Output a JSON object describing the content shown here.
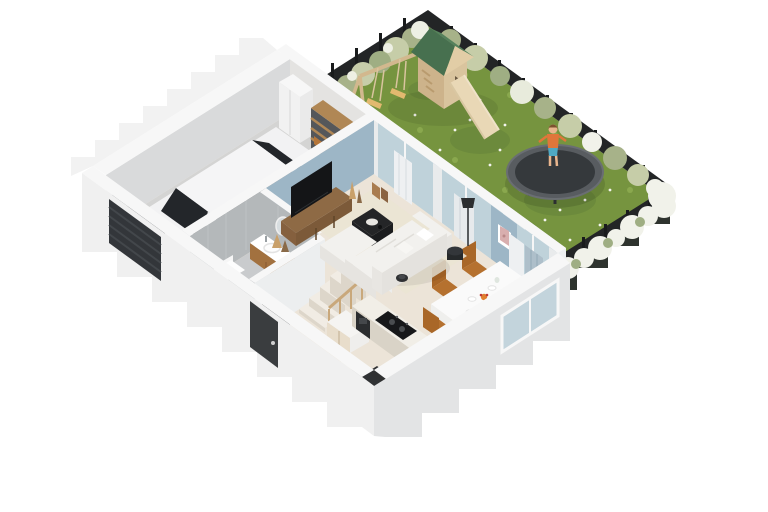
{
  "meta": {
    "description": "Isometric 3D cutaway rendering of a single-family house ground floor with attached garage and fenced garden",
    "view": "isometric-birdseye"
  },
  "colors": {
    "background": "#ffffff",
    "grass": "#76943f",
    "grassLight": "#8fae52",
    "grassDark": "#64823a",
    "fence": "#232526",
    "fencePost": "#191b1c",
    "fenceBelow": "#2e332e",
    "bushSage": "#a7b289",
    "bushLightGreen": "#c6cda8",
    "blossomWhite": "#f1f2ea",
    "playWood": "#d9c49e",
    "playWoodShade": "#cdb38b",
    "roofGreen": "#47704f",
    "roofGreenLight": "#55815c",
    "slideWood": "#e9d8b6",
    "swingSeat": "#e2b96f",
    "trampolineMat": "#35393c",
    "trampolineRim": "#585c60",
    "childShirt": "#e0763a",
    "childShorts": "#4fa8c2",
    "childSkin": "#e9b68e",
    "childHair": "#7d5230",
    "wallTop": "#f7f7f7",
    "wallInner": "#d9dadb",
    "wallOuterLight": "#f0f0f0",
    "wallOuterMid": "#e3e4e5",
    "wallFaceGarden": "#edf0f1",
    "accentBlue": "#9db6c6",
    "glass": "#bfd2da",
    "glassOuter": "#c3d4dc",
    "curtainWhite": "#eef0f2",
    "curtainGray": "#e7eaec",
    "curtainBlue": "#aebfca",
    "floorBeige": "#ece4d8",
    "garageFloor": "#d4d4d3",
    "bathFloor": "#c9cbcd",
    "bathWall": "#b4b8ba",
    "rug": "#ebe4d4",
    "doorDark": "#3a3d3f",
    "garageDoor": "#33363a",
    "mat": "#202224",
    "carBody": "#f2f2f3",
    "carGlass": "#23262a",
    "carWheel": "#232527",
    "sofa": "#f2f1ee",
    "sofaShade": "#e6e4e0",
    "tableBlack": "#242527",
    "woodFurniture": "#8e6a45",
    "tvBlack": "#141517",
    "counterFront": "#d9d3c7",
    "counterTop": "#f1eee7",
    "cooktop": "#17181a",
    "applianceDark": "#2b2d2f",
    "diningWhite": "#fafafa",
    "chairCaramel": "#b5712f",
    "chairShade": "#a96728",
    "vanityWood": "#a2713f",
    "ceramic": "#ffffff",
    "stairTread": "#f1ece4",
    "stairRail": "#c9a87b",
    "picnicWhite": "#f2f1ee"
  },
  "scene": {
    "house": {
      "rooms": [
        {
          "name": "garage",
          "objects": [
            "white-coupe-car",
            "sectional-garage-door",
            "tall-storage-cabinet",
            "wood-storage-shelf"
          ]
        },
        {
          "name": "living-room",
          "objects": [
            "corner-sofa",
            "coffee-table",
            "tv-sideboard",
            "flat-tv",
            "area-rug",
            "curtains",
            "framed-art",
            "side-pouf",
            "robot-vacuum",
            "decor-vases",
            "paper-bags"
          ]
        },
        {
          "name": "dining-area",
          "objects": [
            "dining-table",
            "five-chairs",
            "plates",
            "fruit-bowl"
          ]
        },
        {
          "name": "kitchen",
          "objects": [
            "counter-run",
            "cooktop",
            "built-in-appliances",
            "sink-unit",
            "floor-mat",
            "potted-plant"
          ]
        },
        {
          "name": "bathroom",
          "objects": [
            "wood-vanity-with-sink",
            "round-mirror",
            "toilet"
          ]
        },
        {
          "name": "hallway",
          "objects": [
            "front-door",
            "doormat",
            "staircase",
            "under-stair-cabinets"
          ]
        }
      ]
    },
    "garden": {
      "objects": [
        "lawn",
        "play-tower-green-roof",
        "slide",
        "swing-set",
        "trampoline",
        "child-figure",
        "picnic-table-with-bench",
        "flowering-hedges",
        "dark-fence"
      ]
    }
  }
}
